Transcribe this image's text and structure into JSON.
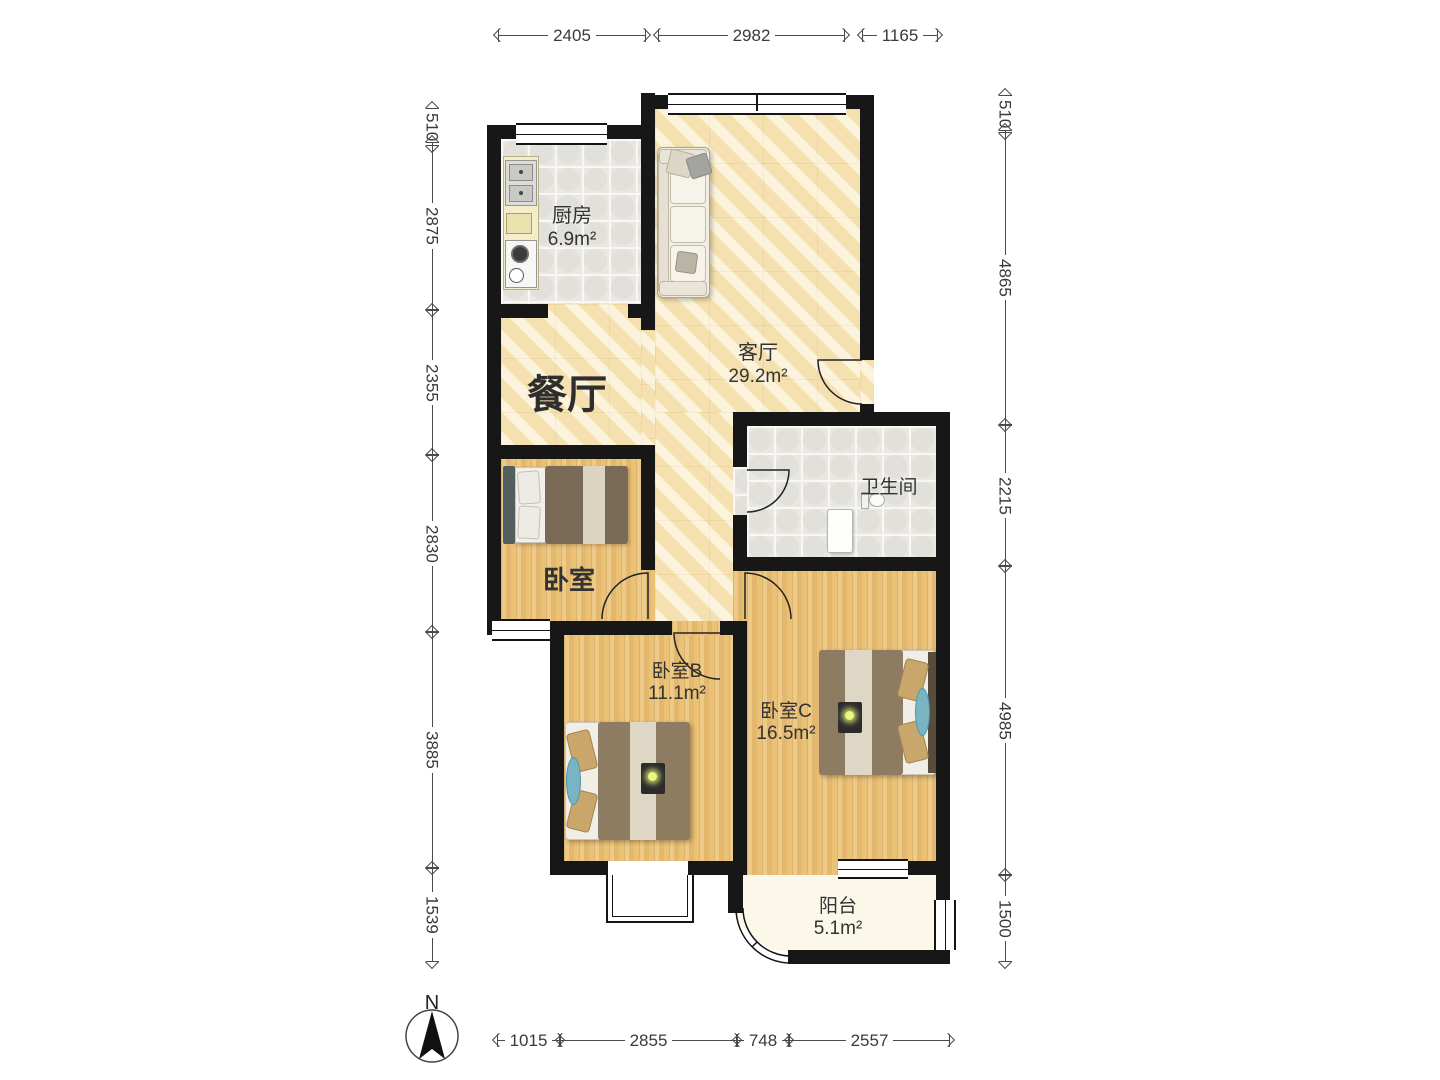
{
  "compass": {
    "label": "N"
  },
  "rooms": {
    "kitchen": {
      "name": "厨房",
      "area": "6.9m²"
    },
    "dining": {
      "name": "餐厅"
    },
    "living": {
      "name": "客厅",
      "area": "29.2m²"
    },
    "bathroom": {
      "name": "卫生间"
    },
    "bedroomA": {
      "name": "卧室"
    },
    "bedroomB": {
      "name": "卧室B",
      "area": "11.1m²"
    },
    "bedroomC": {
      "name": "卧室C",
      "area": "16.5m²"
    },
    "balcony": {
      "name": "阳台",
      "area": "5.1m²"
    }
  },
  "dimensions": {
    "top": [
      "2405",
      "2982",
      "1165"
    ],
    "left": [
      "510",
      "2875",
      "2355",
      "2830",
      "3885",
      "1539"
    ],
    "right": [
      "510",
      "4865",
      "2215",
      "4985",
      "1500"
    ],
    "bottom": [
      "1015",
      "2855",
      "748",
      "2557"
    ]
  },
  "colors": {
    "wall": "#171717",
    "floor_wood": "#ebc175",
    "floor_marble": "#f8e9bd",
    "floor_tile": "#e9e7e1",
    "floor_balcony": "#fbf8e9"
  }
}
